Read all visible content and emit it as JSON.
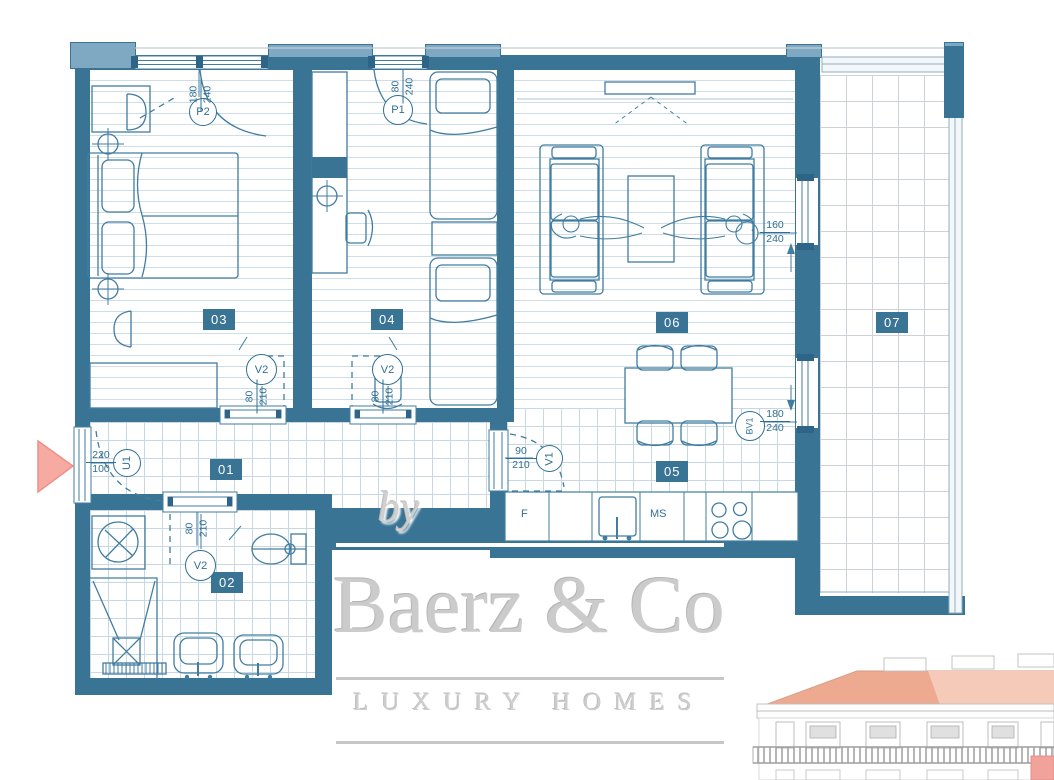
{
  "colors": {
    "wall": "#3a7495",
    "wall_light": "#7fa9c3",
    "line": "#417da1",
    "floor_line": "#cfdde6",
    "accent_pink": "#f6aaa2",
    "roof": "#edaa91",
    "unit_highlight": "#f0a29b",
    "watermark": "#cbcbcb"
  },
  "rooms": {
    "r1": "01",
    "r2": "02",
    "r3": "03",
    "r4": "04",
    "r5": "05",
    "r6": "06",
    "r7": "07"
  },
  "openings": {
    "p2": {
      "label": "P2",
      "w": "180",
      "h": "240"
    },
    "p1": {
      "label": "P1",
      "w": "80",
      "h": "240"
    },
    "u1": {
      "label": "U1",
      "w": "220",
      "h": "100"
    },
    "v2a": {
      "label": "V2",
      "w": "80",
      "h": "210"
    },
    "v2b": {
      "label": "V2",
      "w": "80",
      "h": "210"
    },
    "v2c": {
      "label": "V2",
      "w": "80",
      "h": "210"
    },
    "v1": {
      "label": "V1",
      "w": "90",
      "h": "210"
    },
    "bv1": {
      "label": "BV1",
      "w": "180",
      "h": "240"
    },
    "w1": {
      "w": "160",
      "h": "240"
    }
  },
  "kitchen": {
    "fridge_label": "F",
    "ms_label": "MS"
  },
  "watermark": {
    "prefix": "by",
    "brand": "Baerz & Co",
    "tagline": "LUXURY HOMES"
  }
}
